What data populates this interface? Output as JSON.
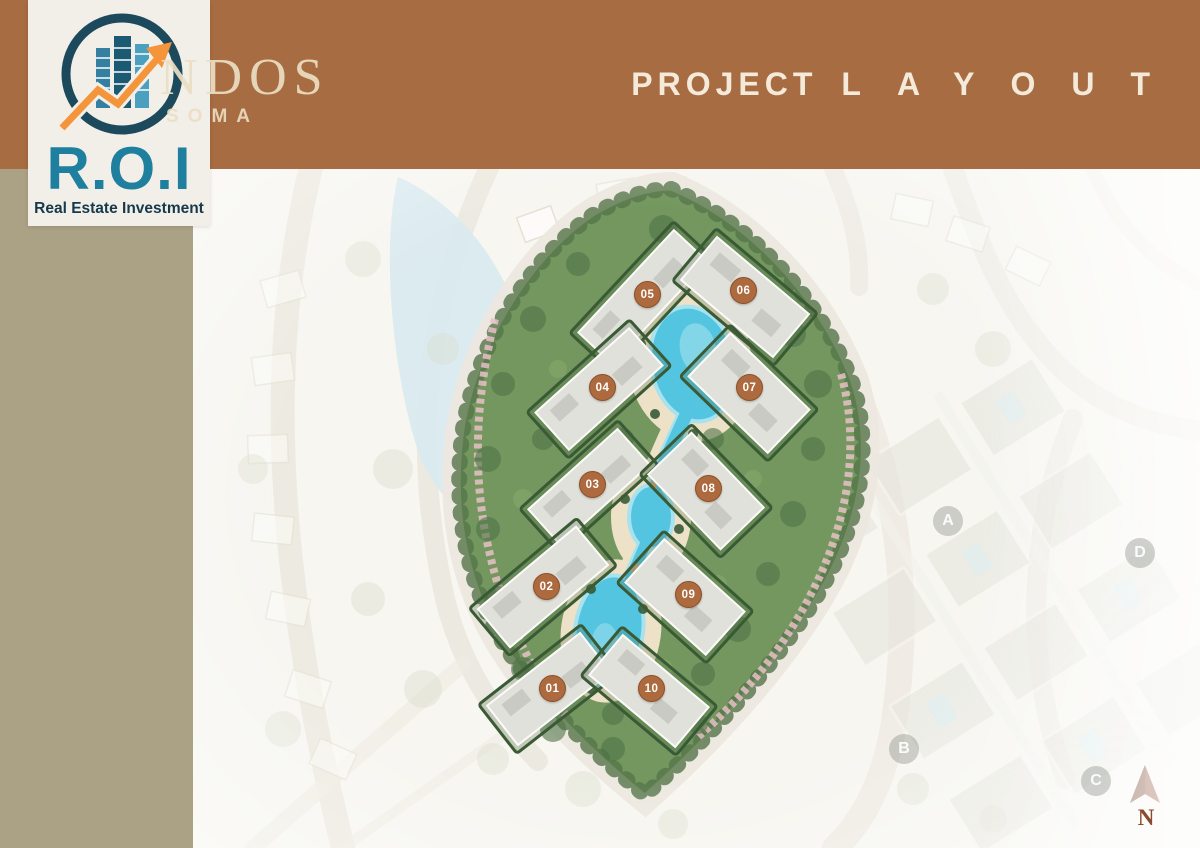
{
  "header": {
    "title_primary": "PROJECT",
    "title_secondary": "LAYOUT",
    "watermark_line1": "NDOS",
    "watermark_line2": "SOMA"
  },
  "logo": {
    "acronym": "R.O.I",
    "tagline": "Real Estate Investment"
  },
  "map": {
    "markers": [
      {
        "label": "01"
      },
      {
        "label": "02"
      },
      {
        "label": "03"
      },
      {
        "label": "04"
      },
      {
        "label": "05"
      },
      {
        "label": "06"
      },
      {
        "label": "07"
      },
      {
        "label": "08"
      },
      {
        "label": "09"
      },
      {
        "label": "10"
      }
    ],
    "districts": [
      {
        "label": "A"
      },
      {
        "label": "B"
      },
      {
        "label": "C"
      },
      {
        "label": "D"
      }
    ],
    "compass": {
      "label": "N"
    }
  },
  "colors": {
    "header_brown": "#A86C42",
    "sidebar_olive": "#ABA185",
    "title_cream": "#F3EADA",
    "wm_cream": "#EBDFC4",
    "logo_teal": "#1F7F9F",
    "logo_navy": "#16394B",
    "logo_orange": "#F4943B",
    "marker_brown": "#AC6A3E",
    "lagoon_cyan": "#54C5E0",
    "compass_brown": "#8A4A2D"
  }
}
